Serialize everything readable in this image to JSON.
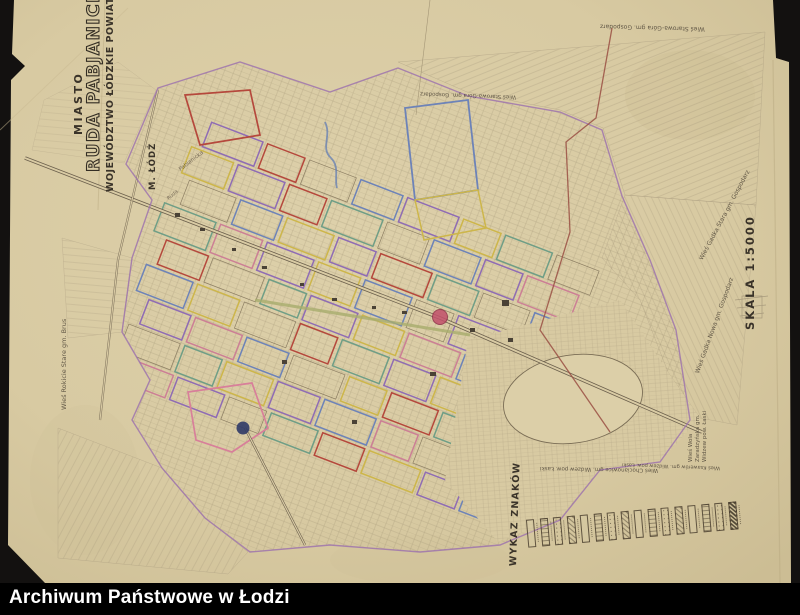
{
  "archive_bar": {
    "label": "Archiwum Państwowe w Łodzi"
  },
  "map": {
    "title": {
      "prefix": "MIASTO",
      "name": "RUDA PABJANICKA",
      "subtitle": "WOJEWÓDZTWO ŁÓDZKIE POWIAT ŁÓDZKI",
      "adjacent_city": "M. ŁÓDŹ"
    },
    "scale": {
      "label": "SKALA 1:5000"
    },
    "legend": {
      "title": "WYKAZ ZNAKÓW",
      "item_count": 16
    },
    "street_labels": [
      {
        "text": "Pabianicka"
      },
      {
        "text": "Ruda"
      }
    ],
    "edge_labels": [
      {
        "text": "Wieś Starowa-Góra gm. Gospodarz"
      },
      {
        "text": "Wieś Starowa-Góra gm. Gospodarz"
      },
      {
        "text": "Wieś Gadka Stara gm. Gospodarz"
      },
      {
        "text": "Wieś Gadka Nowa gm. Gospodarz"
      },
      {
        "text": "Wieś Wola Zaradzyńska gm. Widzew pow. Łaski"
      },
      {
        "text": "Wieś Ksawerów gm. Widzew pow. Łaski"
      },
      {
        "text": "Wieś Chocianowice gm. Widzew pow. Łaski"
      },
      {
        "text": "Wieś Rokicie Stare gm. Brus"
      }
    ],
    "markers": [
      {
        "name": "red-dot-marker"
      },
      {
        "name": "navy-dot-marker"
      }
    ],
    "colors": {
      "scan_background": "#131110",
      "paper": "#d9cba4",
      "ink": "#3a3329",
      "line_sepia": "#8d7f63",
      "boundary_purple": "#9b6fae",
      "boundary_maroon": "#9a4f43",
      "parcel_red": "#b5483c",
      "parcel_purple": "#8f6cb4",
      "parcel_yellow": "#cdb64a",
      "parcel_blue": "#6d83b8",
      "parcel_teal": "#6f9e86",
      "parcel_pink": "#cc7f95",
      "road_olive": "#a8ad6d",
      "marker_red": "#c2506b",
      "marker_navy": "#2f3a67"
    }
  }
}
